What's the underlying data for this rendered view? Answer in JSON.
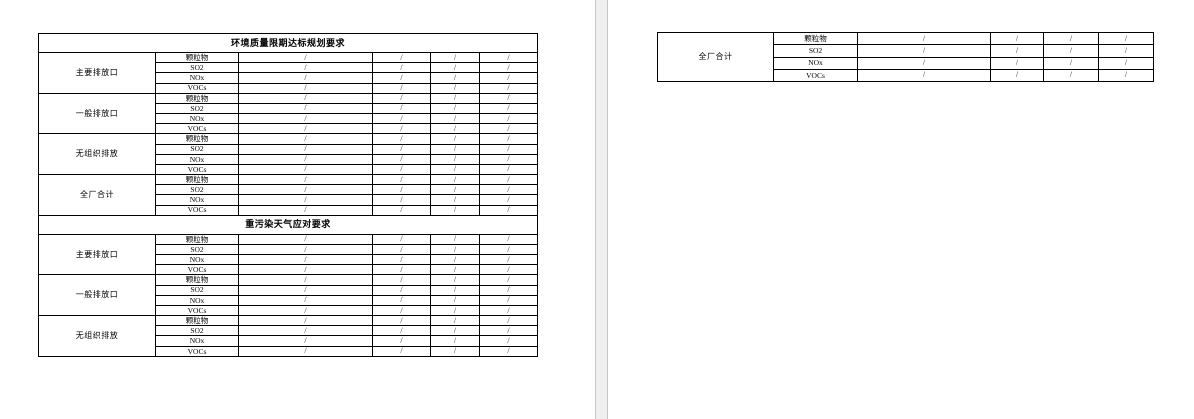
{
  "app": {
    "page_background": "#ffffff",
    "gap_background": "#efefef",
    "table_border_color": "#000000"
  },
  "page1_table": {
    "sections": [
      {
        "title": "环境质量限期达标规划要求",
        "groups": [
          {
            "label": "主要排放口",
            "rows": [
              {
                "pollutant": "颗粒物",
                "values": [
                  "/",
                  "/",
                  "/",
                  "/"
                ]
              },
              {
                "pollutant": "SO2",
                "values": [
                  "/",
                  "/",
                  "/",
                  "/"
                ]
              },
              {
                "pollutant": "NOx",
                "values": [
                  "/",
                  "/",
                  "/",
                  "/"
                ]
              },
              {
                "pollutant": "VOCs",
                "values": [
                  "/",
                  "/",
                  "/",
                  "/"
                ]
              }
            ]
          },
          {
            "label": "一般排放口",
            "rows": [
              {
                "pollutant": "颗粒物",
                "values": [
                  "/",
                  "/",
                  "/",
                  "/"
                ]
              },
              {
                "pollutant": "SO2",
                "values": [
                  "/",
                  "/",
                  "/",
                  "/"
                ]
              },
              {
                "pollutant": "NOx",
                "values": [
                  "/",
                  "/",
                  "/",
                  "/"
                ]
              },
              {
                "pollutant": "VOCs",
                "values": [
                  "/",
                  "/",
                  "/",
                  "/"
                ]
              }
            ]
          },
          {
            "label": "无组织排放",
            "rows": [
              {
                "pollutant": "颗粒物",
                "values": [
                  "/",
                  "/",
                  "/",
                  "/"
                ]
              },
              {
                "pollutant": "SO2",
                "values": [
                  "/",
                  "/",
                  "/",
                  "/"
                ]
              },
              {
                "pollutant": "NOx",
                "values": [
                  "/",
                  "/",
                  "/",
                  "/"
                ]
              },
              {
                "pollutant": "VOCs",
                "values": [
                  "/",
                  "/",
                  "/",
                  "/"
                ]
              }
            ]
          },
          {
            "label": "全厂合计",
            "rows": [
              {
                "pollutant": "颗粒物",
                "values": [
                  "/",
                  "/",
                  "/",
                  "/"
                ]
              },
              {
                "pollutant": "SO2",
                "values": [
                  "/",
                  "/",
                  "/",
                  "/"
                ]
              },
              {
                "pollutant": "NOx",
                "values": [
                  "/",
                  "/",
                  "/",
                  "/"
                ]
              },
              {
                "pollutant": "VOCs",
                "values": [
                  "/",
                  "/",
                  "/",
                  "/"
                ]
              }
            ]
          }
        ]
      },
      {
        "title": "重污染天气应对要求",
        "groups": [
          {
            "label": "主要排放口",
            "rows": [
              {
                "pollutant": "颗粒物",
                "values": [
                  "/",
                  "/",
                  "/",
                  "/"
                ]
              },
              {
                "pollutant": "SO2",
                "values": [
                  "/",
                  "/",
                  "/",
                  "/"
                ]
              },
              {
                "pollutant": "NOx",
                "values": [
                  "/",
                  "/",
                  "/",
                  "/"
                ]
              },
              {
                "pollutant": "VOCs",
                "values": [
                  "/",
                  "/",
                  "/",
                  "/"
                ]
              }
            ]
          },
          {
            "label": "一般排放口",
            "rows": [
              {
                "pollutant": "颗粒物",
                "values": [
                  "/",
                  "/",
                  "/",
                  "/"
                ]
              },
              {
                "pollutant": "SO2",
                "values": [
                  "/",
                  "/",
                  "/",
                  "/"
                ]
              },
              {
                "pollutant": "NOx",
                "values": [
                  "/",
                  "/",
                  "/",
                  "/"
                ]
              },
              {
                "pollutant": "VOCs",
                "values": [
                  "/",
                  "/",
                  "/",
                  "/"
                ]
              }
            ]
          },
          {
            "label": "无组织排放",
            "rows": [
              {
                "pollutant": "颗粒物",
                "values": [
                  "/",
                  "/",
                  "/",
                  "/"
                ]
              },
              {
                "pollutant": "SO2",
                "values": [
                  "/",
                  "/",
                  "/",
                  "/"
                ]
              },
              {
                "pollutant": "NOx",
                "values": [
                  "/",
                  "/",
                  "/",
                  "/"
                ]
              },
              {
                "pollutant": "VOCs",
                "values": [
                  "/",
                  "/",
                  "/",
                  "/"
                ]
              }
            ]
          }
        ]
      }
    ]
  },
  "page2_table": {
    "sections": [
      {
        "title": null,
        "groups": [
          {
            "label": "全厂合计",
            "rows": [
              {
                "pollutant": "颗粒物",
                "values": [
                  "/",
                  "/",
                  "/",
                  "/"
                ]
              },
              {
                "pollutant": "SO2",
                "values": [
                  "/",
                  "/",
                  "/",
                  "/"
                ]
              },
              {
                "pollutant": "NOx",
                "values": [
                  "/",
                  "/",
                  "/",
                  "/"
                ]
              },
              {
                "pollutant": "VOCs",
                "values": [
                  "/",
                  "/",
                  "/",
                  "/"
                ]
              }
            ]
          }
        ]
      }
    ]
  },
  "layout": {
    "page1_col_widths": [
      117,
      83,
      134,
      58,
      49,
      58
    ],
    "page2_col_widths": [
      116,
      84,
      133,
      53,
      55,
      55
    ],
    "title_row_height": 19
  }
}
